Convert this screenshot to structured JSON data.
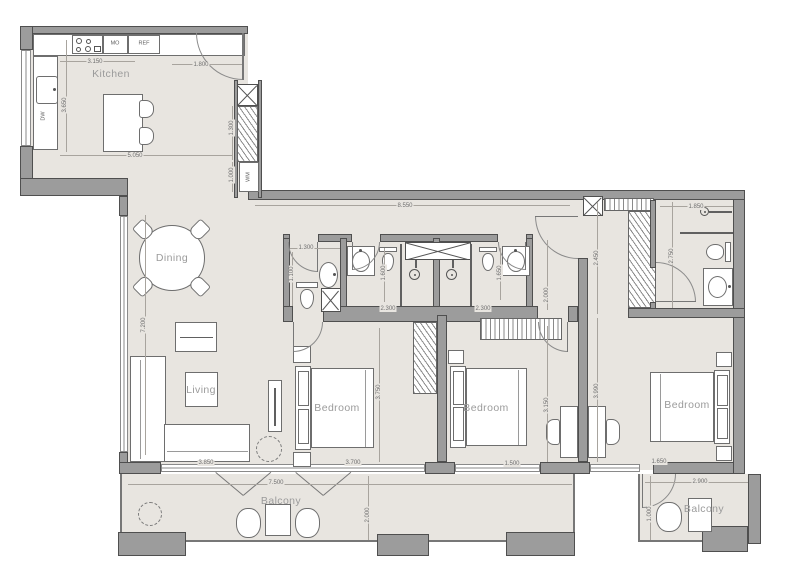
{
  "rooms": [
    {
      "label": "Kitchen",
      "x": 111,
      "y": 74
    },
    {
      "label": "Dining",
      "x": 172,
      "y": 258
    },
    {
      "label": "Living",
      "x": 201,
      "y": 390
    },
    {
      "label": "Bedroom",
      "x": 337,
      "y": 408
    },
    {
      "label": "Bedroom",
      "x": 486,
      "y": 408
    },
    {
      "label": "Bedroom",
      "x": 687,
      "y": 405
    },
    {
      "label": "Balcony",
      "x": 281,
      "y": 501
    },
    {
      "label": "Balcony",
      "x": 704,
      "y": 509
    }
  ],
  "tags": [
    {
      "label": "MO",
      "x": 115,
      "y": 44,
      "o": "h"
    },
    {
      "label": "REF",
      "x": 144,
      "y": 44,
      "o": "h"
    },
    {
      "label": "DW",
      "x": 44,
      "y": 116,
      "o": "v"
    },
    {
      "label": "WM",
      "x": 249,
      "y": 177,
      "o": "v"
    }
  ],
  "dims": [
    {
      "t": "3.150",
      "x": 95,
      "y": 62,
      "o": "h"
    },
    {
      "t": "1.800",
      "x": 201,
      "y": 65,
      "o": "h"
    },
    {
      "t": "3.650",
      "x": 65,
      "y": 105,
      "o": "v"
    },
    {
      "t": "5.050",
      "x": 135,
      "y": 156,
      "o": "h"
    },
    {
      "t": "1.300",
      "x": 232,
      "y": 128,
      "o": "v"
    },
    {
      "t": "1.000",
      "x": 232,
      "y": 175,
      "o": "v"
    },
    {
      "t": "8.550",
      "x": 405,
      "y": 206,
      "o": "h"
    },
    {
      "t": "7.200",
      "x": 144,
      "y": 325,
      "o": "v"
    },
    {
      "t": "1.300",
      "x": 306,
      "y": 248,
      "o": "h"
    },
    {
      "t": "1.100",
      "x": 292,
      "y": 274,
      "o": "v"
    },
    {
      "t": "1.600",
      "x": 384,
      "y": 273,
      "o": "v"
    },
    {
      "t": "2.300",
      "x": 388,
      "y": 309,
      "o": "h"
    },
    {
      "t": "2.300",
      "x": 483,
      "y": 309,
      "o": "h"
    },
    {
      "t": "1.650",
      "x": 500,
      "y": 273,
      "o": "v"
    },
    {
      "t": "2.450",
      "x": 597,
      "y": 258,
      "o": "v"
    },
    {
      "t": "1.850",
      "x": 696,
      "y": 207,
      "o": "h"
    },
    {
      "t": "2.750",
      "x": 672,
      "y": 256,
      "o": "v"
    },
    {
      "t": "2.000",
      "x": 547,
      "y": 295,
      "o": "v"
    },
    {
      "t": "3.150",
      "x": 547,
      "y": 405,
      "o": "v"
    },
    {
      "t": "3.990",
      "x": 597,
      "y": 391,
      "o": "v"
    },
    {
      "t": "3.750",
      "x": 379,
      "y": 392,
      "o": "v"
    },
    {
      "t": "3.850",
      "x": 206,
      "y": 463,
      "o": "h"
    },
    {
      "t": "3.700",
      "x": 353,
      "y": 463,
      "o": "h"
    },
    {
      "t": "1.500",
      "x": 512,
      "y": 464,
      "o": "h"
    },
    {
      "t": "1.650",
      "x": 659,
      "y": 462,
      "o": "h"
    },
    {
      "t": "7.500",
      "x": 276,
      "y": 483,
      "o": "h"
    },
    {
      "t": "2.000",
      "x": 368,
      "y": 515,
      "o": "v"
    },
    {
      "t": "2.900",
      "x": 700,
      "y": 482,
      "o": "h"
    },
    {
      "t": "1.000",
      "x": 650,
      "y": 514,
      "o": "v"
    }
  ],
  "colors": {
    "floor": "#e8e5e0",
    "wall": "#9c9c9c",
    "wall_outline": "#4f4f4f",
    "furniture_outline": "#6e6e6e",
    "room_label": "#9b9b9b",
    "dim_text": "#6f6f6f"
  }
}
